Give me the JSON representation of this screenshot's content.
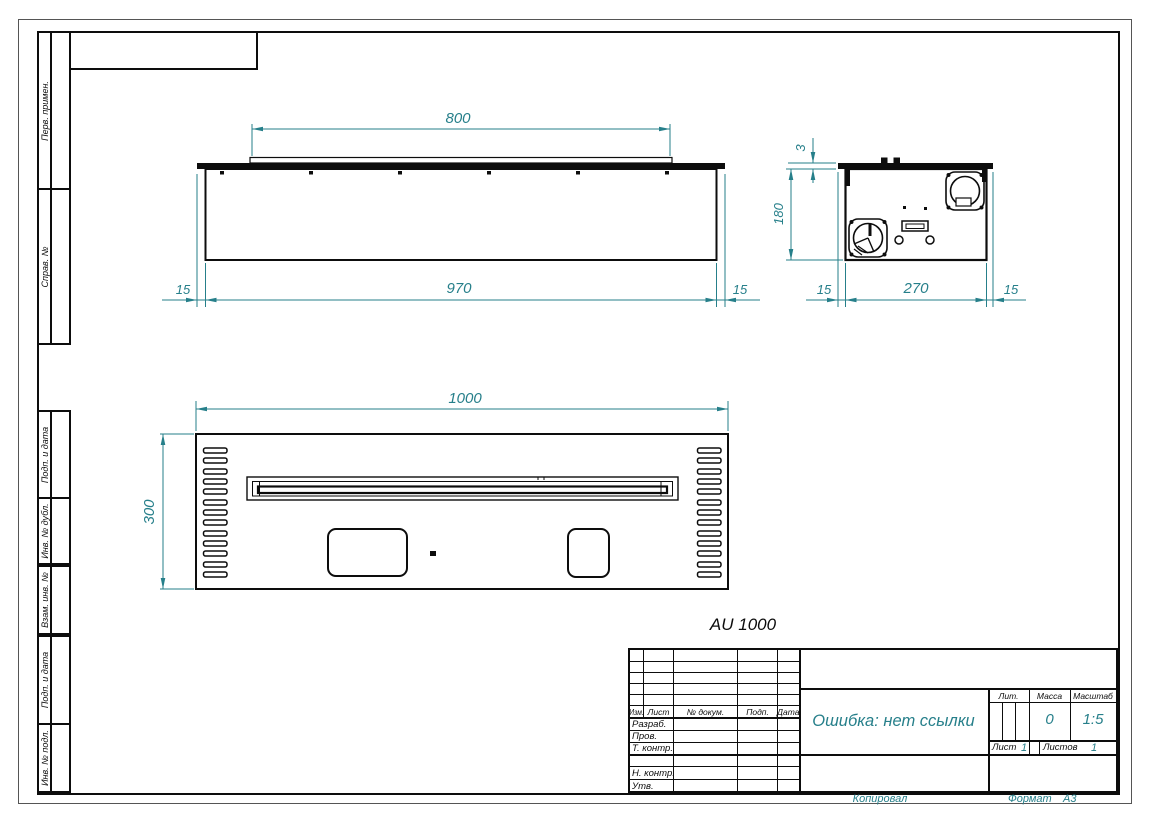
{
  "colors": {
    "dimension": "#267f8a",
    "line": "#0d0d0d"
  },
  "margin_strip": {
    "top_cells": [
      {
        "label": "Перв. примен."
      },
      {
        "label": "Справ. №"
      }
    ],
    "bottom_cells": [
      {
        "label": "Подп. и дата"
      },
      {
        "label": "Инв. № дубл."
      },
      {
        "label": "Взам. инв. №"
      },
      {
        "label": "Подп. и дата"
      },
      {
        "label": "Инв. № подл."
      }
    ]
  },
  "views": {
    "label": "AU 1000",
    "front": {
      "dim_top": "800",
      "dim_bottom": "970",
      "dim_left": "15",
      "dim_right": "15"
    },
    "side": {
      "dim_flange": "3",
      "dim_height": "180",
      "dim_left": "15",
      "dim_width": "270",
      "dim_right": "15"
    },
    "plan": {
      "dim_width": "1000",
      "dim_depth": "300"
    }
  },
  "title_block": {
    "header_cols": [
      "Изм.",
      "Лист",
      "№ докум.",
      "Подп.",
      "Дата"
    ],
    "role_rows": [
      "Разраб.",
      "Пров.",
      "Т. контр.",
      "",
      "Н. контр.",
      "Утв."
    ],
    "doc_name": "Ошибка: нет ссылки",
    "lit_label": "Лит.",
    "mass_label": "Масса",
    "mass_value": "0",
    "scale_label": "Масштаб",
    "scale_value": "1:5",
    "sheet_label": "Лист",
    "sheet_value": "1",
    "sheets_label": "Листов",
    "sheets_value": "1"
  },
  "footer": {
    "copied": "Копировал",
    "format_label": "Формат",
    "format_value": "A3"
  }
}
